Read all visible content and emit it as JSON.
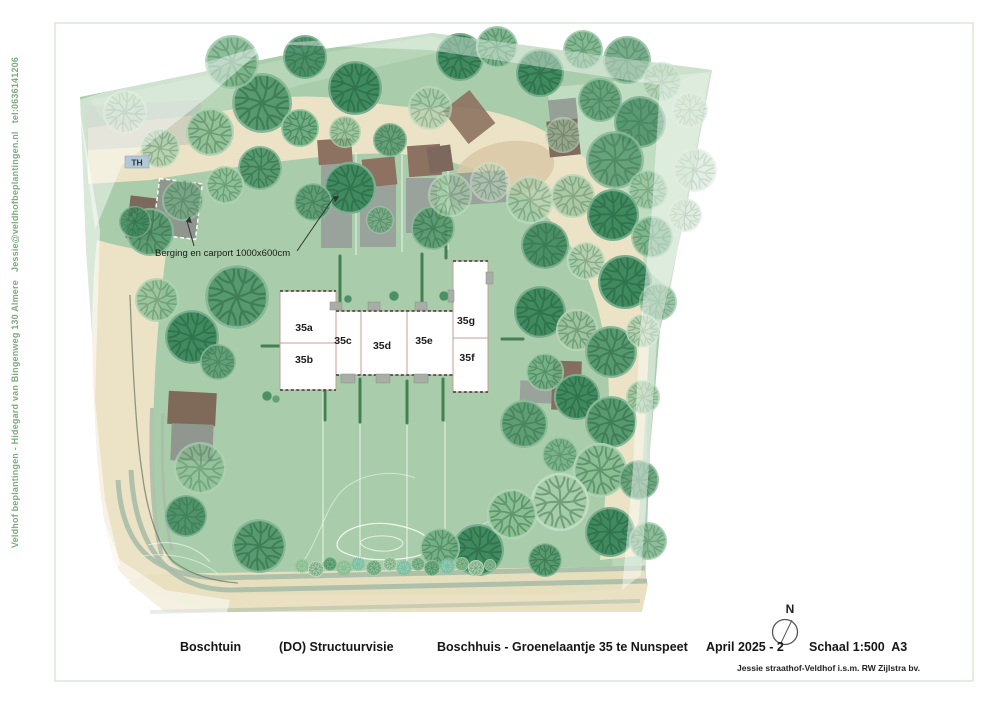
{
  "sidebar": {
    "credit": "Veldhof beplantingen - Hidegard van Bingenweg 130 Almere   Jessie@veldhofbeplantingen.nl   tel:0636141206"
  },
  "footer": {
    "project": "Boschtuin",
    "phase": "(DO) Structuurvisie",
    "address": "Boschhuis - Groenelaantje 35 te Nunspeet",
    "date": "April 2025 - 2",
    "scale": "Schaal 1:500  A3",
    "byline": "Jessie straathof-Veldhof i.s.m. RW Zijlstra bv."
  },
  "plan": {
    "north_label": "N",
    "th_label": "TH",
    "annotation": "Berging en carport 1000x600cm",
    "colors": {
      "site_green": "#a9cdaa",
      "light_green": "#c6dfc6",
      "path_beige": "#ece3c6",
      "road_beige": "#e9dfbf",
      "road_stripe": "#a9bca7",
      "roof_brown": "#8d7261",
      "pad_gray": "#9aa39b",
      "building_outline": "#c59c96",
      "frame_green": "#cfe2cf",
      "th_badge": "#b3c7d6"
    },
    "palette": [
      "#2e7a50",
      "#3f8a5e",
      "#569a6e",
      "#6fae80",
      "#8abf92",
      "#a5cda8",
      "#bdd8be",
      "#9cc49c",
      "#7fc0a4"
    ],
    "units": [
      {
        "label": "35a",
        "x": 304,
        "y": 331
      },
      {
        "label": "35b",
        "x": 304,
        "y": 363
      },
      {
        "label": "35c",
        "x": 343,
        "y": 344
      },
      {
        "label": "35d",
        "x": 382,
        "y": 349
      },
      {
        "label": "35e",
        "x": 424,
        "y": 344
      },
      {
        "label": "35f",
        "x": 467,
        "y": 361
      },
      {
        "label": "35g",
        "x": 466,
        "y": 324
      }
    ],
    "structures": [
      {
        "x": 86,
        "y": 103,
        "w": 116,
        "h": 44,
        "rot": -3,
        "f": "#b6bbb4",
        "o": 0.5
      },
      {
        "x": 128,
        "y": 197,
        "w": 30,
        "h": 43,
        "rot": 7,
        "f": "#7c685c"
      },
      {
        "x": 156,
        "y": 181,
        "w": 43,
        "h": 56,
        "rot": 7,
        "f": "#8e968e",
        "dash": 1
      },
      {
        "x": 321,
        "y": 162,
        "w": 31,
        "h": 86,
        "f": "#9aa39b"
      },
      {
        "x": 360,
        "y": 178,
        "w": 36,
        "h": 69,
        "f": "#9aa39b"
      },
      {
        "x": 406,
        "y": 178,
        "w": 31,
        "h": 55,
        "f": "#9aa39b"
      },
      {
        "x": 450,
        "y": 172,
        "w": 56,
        "h": 32,
        "rot": -4,
        "f": "#9aa39b"
      },
      {
        "x": 318,
        "y": 139,
        "w": 34,
        "h": 25,
        "rot": -4,
        "f": "#8d7261"
      },
      {
        "x": 363,
        "y": 158,
        "w": 33,
        "h": 28,
        "rot": -6,
        "f": "#8d7261"
      },
      {
        "x": 408,
        "y": 145,
        "w": 33,
        "h": 31,
        "rot": -4,
        "f": "#8d7261"
      },
      {
        "x": 428,
        "y": 146,
        "w": 24,
        "h": 26,
        "rot": -8,
        "f": "#7c685c"
      },
      {
        "x": 452,
        "y": 96,
        "w": 34,
        "h": 42,
        "rot": -38,
        "f": "#8d7261",
        "o": 0.9
      },
      {
        "x": 549,
        "y": 99,
        "w": 28,
        "h": 24,
        "rot": -6,
        "f": "#97a097"
      },
      {
        "x": 548,
        "y": 120,
        "w": 31,
        "h": 36,
        "rot": -6,
        "f": "#7f6c5f"
      },
      {
        "x": 520,
        "y": 381,
        "w": 33,
        "h": 22,
        "rot": 2,
        "f": "#9aa39b"
      },
      {
        "x": 552,
        "y": 361,
        "w": 29,
        "h": 49,
        "rot": 2,
        "f": "#836e5f"
      },
      {
        "x": 168,
        "y": 392,
        "w": 48,
        "h": 33,
        "rot": 3,
        "f": "#7f6a5a"
      },
      {
        "x": 171,
        "y": 424,
        "w": 42,
        "h": 37,
        "rot": 2,
        "f": "#8f978f"
      }
    ],
    "building_grays": [
      [
        330,
        302,
        12,
        8
      ],
      [
        368,
        302,
        12,
        8
      ],
      [
        415,
        302,
        12,
        8
      ],
      [
        341,
        374,
        14,
        9
      ],
      [
        376,
        374,
        14,
        9
      ],
      [
        414,
        374,
        14,
        9
      ],
      [
        486,
        272,
        7,
        12
      ],
      [
        448,
        290,
        6,
        12
      ]
    ],
    "hedges": [
      [
        340,
        256,
        340,
        306
      ],
      [
        422,
        254,
        422,
        304
      ],
      [
        446,
        228,
        446,
        258
      ],
      [
        325,
        377,
        325,
        420
      ],
      [
        360,
        379,
        360,
        422
      ],
      [
        407,
        381,
        407,
        423
      ],
      [
        443,
        379,
        443,
        420
      ],
      [
        262,
        346,
        281,
        346
      ],
      [
        502,
        339,
        523,
        339
      ]
    ],
    "divlines": [
      [
        356,
        152,
        356,
        255
      ],
      [
        402,
        155,
        402,
        252
      ],
      [
        448,
        160,
        448,
        250
      ],
      [
        323,
        392,
        323,
        563
      ],
      [
        360,
        424,
        360,
        563
      ],
      [
        407,
        424,
        407,
        563
      ],
      [
        445,
        422,
        445,
        563
      ]
    ],
    "trees": [
      [
        125,
        112,
        22,
        6,
        0.55,
        0
      ],
      [
        160,
        148,
        20,
        5,
        0.75,
        0
      ],
      [
        210,
        132,
        24,
        4,
        0.9,
        0
      ],
      [
        262,
        103,
        30,
        2,
        1,
        0
      ],
      [
        232,
        62,
        27,
        3,
        0.8,
        0
      ],
      [
        305,
        57,
        22,
        1,
        0.9,
        0
      ],
      [
        355,
        88,
        27,
        1,
        1,
        0
      ],
      [
        300,
        128,
        19,
        3,
        1,
        0
      ],
      [
        345,
        132,
        16,
        4,
        0.8,
        0
      ],
      [
        390,
        140,
        17,
        2,
        0.9,
        0
      ],
      [
        430,
        108,
        22,
        5,
        0.65,
        0
      ],
      [
        460,
        57,
        24,
        1,
        1,
        0
      ],
      [
        497,
        47,
        21,
        3,
        0.9,
        0
      ],
      [
        540,
        73,
        24,
        1,
        1,
        0
      ],
      [
        583,
        50,
        20,
        3,
        0.85,
        0
      ],
      [
        627,
        60,
        24,
        2,
        0.8,
        0
      ],
      [
        662,
        82,
        20,
        5,
        0.5,
        0
      ],
      [
        690,
        110,
        18,
        6,
        0.45,
        0
      ],
      [
        600,
        100,
        22,
        2,
        0.85,
        0
      ],
      [
        640,
        122,
        26,
        1,
        0.8,
        0
      ],
      [
        563,
        135,
        18,
        5,
        0.6,
        0
      ],
      [
        260,
        168,
        22,
        2,
        1,
        0
      ],
      [
        225,
        185,
        19,
        4,
        0.85,
        0
      ],
      [
        183,
        200,
        21,
        3,
        0.7,
        0
      ],
      [
        150,
        232,
        24,
        2,
        0.9,
        0
      ],
      [
        135,
        222,
        16,
        1,
        0.8,
        0
      ],
      [
        157,
        300,
        22,
        4,
        0.8,
        0
      ],
      [
        192,
        337,
        27,
        1,
        1,
        0
      ],
      [
        218,
        362,
        18,
        2,
        0.85,
        0
      ],
      [
        237,
        297,
        32,
        2,
        1,
        0
      ],
      [
        350,
        188,
        26,
        1,
        1,
        0
      ],
      [
        313,
        202,
        19,
        2,
        0.9,
        0
      ],
      [
        433,
        228,
        22,
        2,
        0.9,
        0
      ],
      [
        380,
        220,
        14,
        3,
        0.8,
        0
      ],
      [
        450,
        195,
        22,
        5,
        0.6,
        0
      ],
      [
        490,
        182,
        20,
        6,
        0.55,
        0
      ],
      [
        530,
        200,
        24,
        5,
        0.7,
        0
      ],
      [
        573,
        196,
        22,
        7,
        0.8,
        0
      ],
      [
        615,
        160,
        29,
        2,
        0.85,
        0
      ],
      [
        648,
        190,
        20,
        4,
        0.7,
        0
      ],
      [
        613,
        215,
        26,
        1,
        1,
        0
      ],
      [
        652,
        237,
        21,
        3,
        0.8,
        0
      ],
      [
        685,
        215,
        17,
        6,
        0.45,
        0
      ],
      [
        545,
        245,
        24,
        1,
        0.9,
        0
      ],
      [
        586,
        261,
        19,
        5,
        0.8,
        0
      ],
      [
        625,
        282,
        27,
        1,
        1,
        0
      ],
      [
        658,
        302,
        19,
        3,
        0.7,
        0
      ],
      [
        695,
        170,
        22,
        6,
        0.4,
        0
      ],
      [
        540,
        312,
        26,
        1,
        1,
        0
      ],
      [
        577,
        330,
        21,
        7,
        0.9,
        0
      ],
      [
        611,
        352,
        26,
        2,
        1,
        0
      ],
      [
        643,
        331,
        17,
        5,
        0.8,
        0
      ],
      [
        545,
        372,
        19,
        3,
        0.9,
        0
      ],
      [
        577,
        397,
        23,
        1,
        1,
        0
      ],
      [
        611,
        422,
        26,
        2,
        1,
        0
      ],
      [
        643,
        397,
        17,
        4,
        0.75,
        0
      ],
      [
        524,
        424,
        24,
        2,
        0.9,
        0
      ],
      [
        560,
        455,
        18,
        3,
        0.8,
        0
      ],
      [
        600,
        470,
        27,
        4,
        1,
        0
      ],
      [
        639,
        480,
        20,
        2,
        0.85,
        0
      ],
      [
        560,
        502,
        29,
        5,
        1,
        0
      ],
      [
        610,
        532,
        25,
        1,
        1,
        0
      ],
      [
        648,
        541,
        19,
        3,
        0.8,
        0
      ],
      [
        545,
        560,
        17,
        2,
        1,
        0
      ],
      [
        200,
        468,
        26,
        4,
        0.7,
        0
      ],
      [
        186,
        516,
        21,
        1,
        0.85,
        0
      ],
      [
        259,
        546,
        27,
        2,
        1,
        0
      ],
      [
        478,
        550,
        26,
        1,
        1,
        0
      ],
      [
        512,
        514,
        25,
        4,
        1,
        0
      ],
      [
        440,
        548,
        20,
        3,
        0.9,
        0
      ],
      [
        302,
        566,
        7,
        4,
        1,
        1
      ],
      [
        316,
        569,
        8,
        5,
        1,
        0
      ],
      [
        330,
        564,
        7,
        3,
        1,
        0
      ],
      [
        344,
        568,
        8,
        4,
        1,
        1
      ],
      [
        358,
        564,
        7,
        8,
        1,
        1
      ],
      [
        374,
        568,
        8,
        4,
        1,
        0
      ],
      [
        390,
        564,
        7,
        5,
        1,
        0
      ],
      [
        404,
        568,
        8,
        8,
        1,
        1
      ],
      [
        418,
        564,
        7,
        4,
        1,
        0
      ],
      [
        432,
        568,
        8,
        3,
        1,
        0
      ],
      [
        447,
        566,
        8,
        8,
        1,
        1
      ],
      [
        462,
        564,
        7,
        4,
        1,
        0
      ],
      [
        476,
        568,
        8,
        5,
        1,
        0
      ],
      [
        490,
        565,
        6,
        4,
        1,
        0
      ],
      [
        444,
        296,
        5,
        2,
        1,
        0
      ],
      [
        452,
        299,
        4,
        3,
        1,
        0
      ],
      [
        394,
        296,
        5,
        2,
        1,
        0
      ],
      [
        348,
        299,
        4,
        2,
        1,
        0
      ],
      [
        267,
        396,
        5,
        2,
        1,
        0
      ],
      [
        276,
        399,
        4,
        3,
        1,
        0
      ]
    ]
  }
}
